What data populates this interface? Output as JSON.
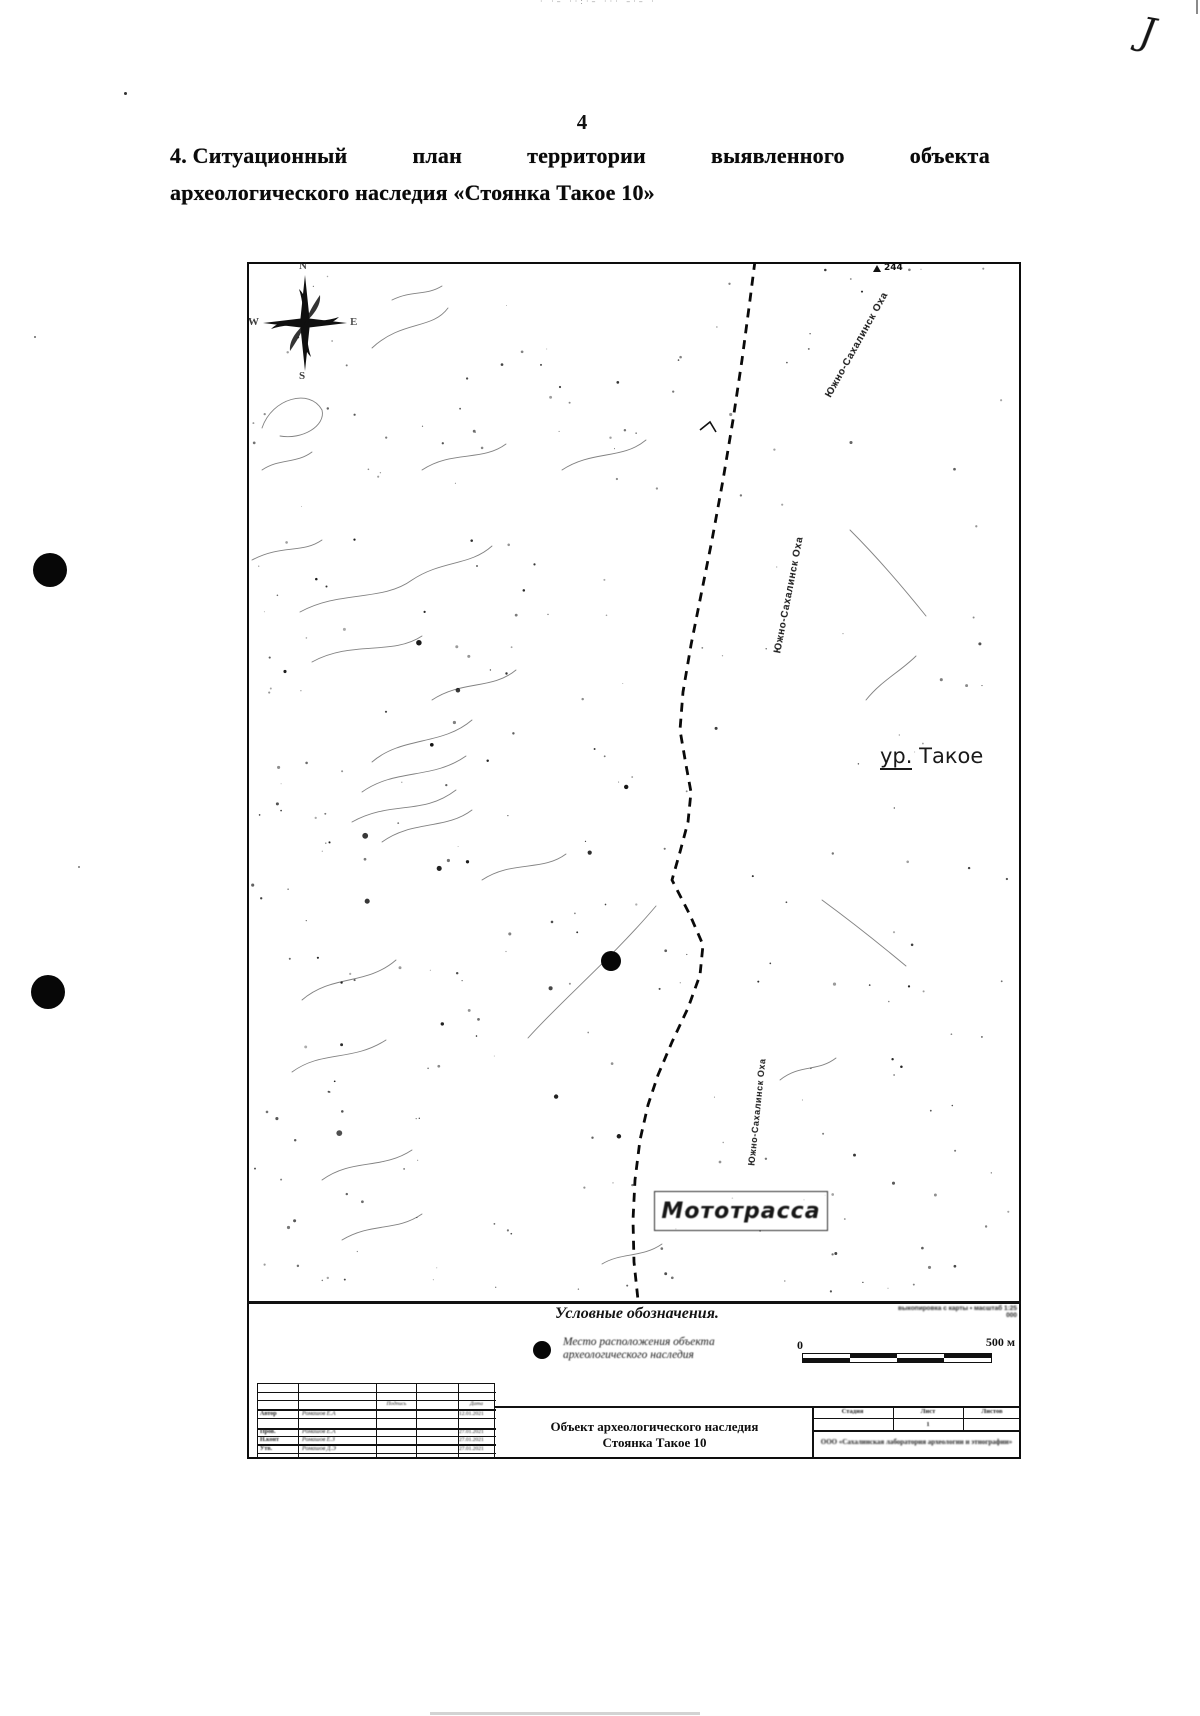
{
  "page": {
    "number": "4",
    "hand_mark": "J",
    "top_edge_fragment": "· ·– ··:·– ··· –·– ·"
  },
  "heading": {
    "words": [
      "4. Ситуационный",
      "план",
      "территории",
      "выявленного",
      "объекта"
    ],
    "line2": "археологического наследия «Стоянка Такое 10»"
  },
  "map": {
    "compass": {
      "n": "N",
      "w": "W",
      "e": "E",
      "s": "S"
    },
    "spot_elevation": "244",
    "road_label": "Южно-Сахалинск  Оха",
    "area_label_prefix": "ур.",
    "area_label_name": "Такое",
    "moto_label": "Мототрасса"
  },
  "legend": {
    "title": "Условные обозначения.",
    "item_line1": "Место расположения объекта",
    "item_line2": "археологического наследия",
    "source_note": "выкопировка с карты • масштаб 1:25 000",
    "scale_zero": "0",
    "scale_label": "500 м"
  },
  "title_block": {
    "doc_title_line1": "Объект археологического наследия",
    "doc_title_line2": "Стоянка Такое 10",
    "header_sign": "Подпись",
    "header_date": "Дата",
    "rows": [
      {
        "role": "Автор",
        "name": "Ромашов Е.А",
        "date": "12.01.2021"
      },
      {
        "role": "Пров.",
        "name": "Ромашов Е.А",
        "date": "27.01.2021"
      },
      {
        "role": "Н.конт",
        "name": "Ромашов Е.З",
        "date": "27.01.2021"
      },
      {
        "role": "Утв.",
        "name": "Ромашов Д.Э",
        "date": "27.01.2021"
      }
    ],
    "stage_cells": [
      "Стадия",
      "Лист",
      "Листов"
    ],
    "sheet_number": "1",
    "organization": "ООО «Сахалинская лаборатория археологии и этнографии»"
  },
  "colors": {
    "ink": "#111111",
    "paper": "#ffffff"
  }
}
